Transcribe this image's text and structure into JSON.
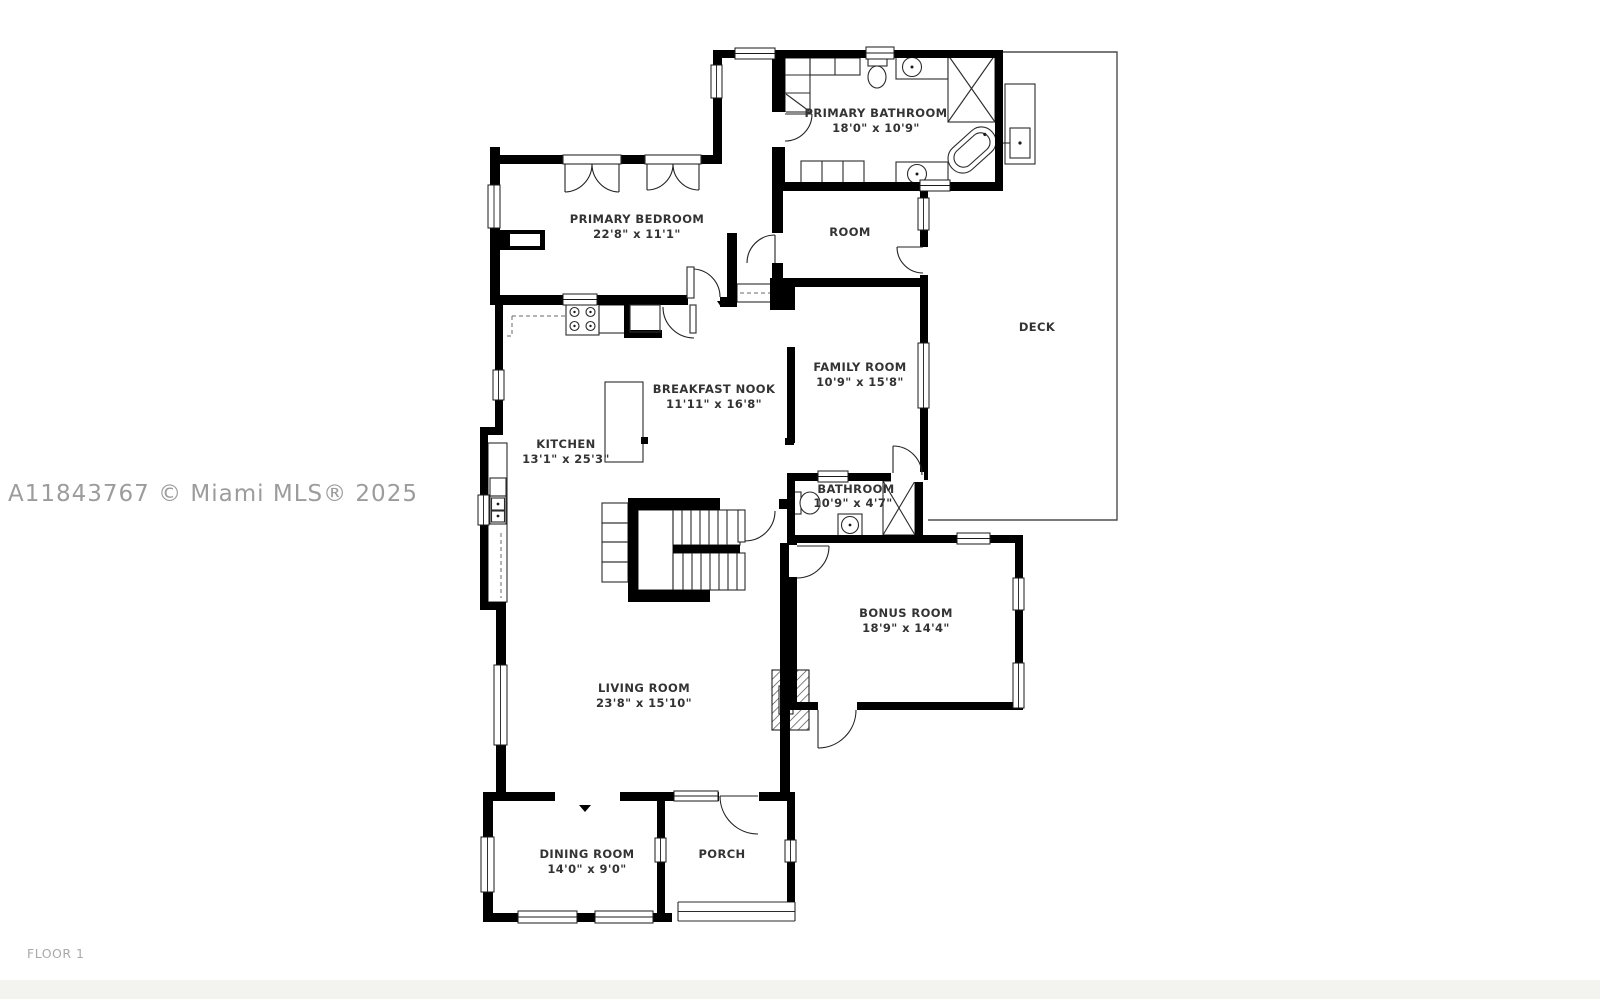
{
  "watermark": "A11843767 © Miami MLS® 2025",
  "floor_label": "FLOOR 1",
  "colors": {
    "wall": "#000000",
    "thin_line": "#2b2b2b",
    "deck_line": "#4d4d4d",
    "label_text": "#333333",
    "watermark_text": "#9c9c9c",
    "floor_label_text": "#a9a9a9",
    "background": "#ffffff",
    "footer_band": "#f3f3f0"
  },
  "rooms": [
    {
      "id": "primary-bathroom",
      "name": "PRIMARY BATHROOM",
      "dims": "18'0\" x 10'9\""
    },
    {
      "id": "primary-bedroom",
      "name": "PRIMARY BEDROOM",
      "dims": "22'8\" x 11'1\""
    },
    {
      "id": "room",
      "name": "ROOM",
      "dims": ""
    },
    {
      "id": "deck",
      "name": "DECK",
      "dims": ""
    },
    {
      "id": "family-room",
      "name": "FAMILY ROOM",
      "dims": "10'9\" x 15'8\""
    },
    {
      "id": "breakfast-nook",
      "name": "BREAKFAST NOOK",
      "dims": "11'11\" x 16'8\""
    },
    {
      "id": "kitchen",
      "name": "KITCHEN",
      "dims": "13'1\" x 25'3\""
    },
    {
      "id": "bathroom",
      "name": "BATHROOM",
      "dims": "10'9\" x 4'7\""
    },
    {
      "id": "bonus-room",
      "name": "BONUS ROOM",
      "dims": "18'9\" x 14'4\""
    },
    {
      "id": "living-room",
      "name": "LIVING ROOM",
      "dims": "23'8\" x 15'10\""
    },
    {
      "id": "dining-room",
      "name": "DINING ROOM",
      "dims": "14'0\" x 9'0\""
    },
    {
      "id": "porch",
      "name": "PORCH",
      "dims": ""
    }
  ]
}
